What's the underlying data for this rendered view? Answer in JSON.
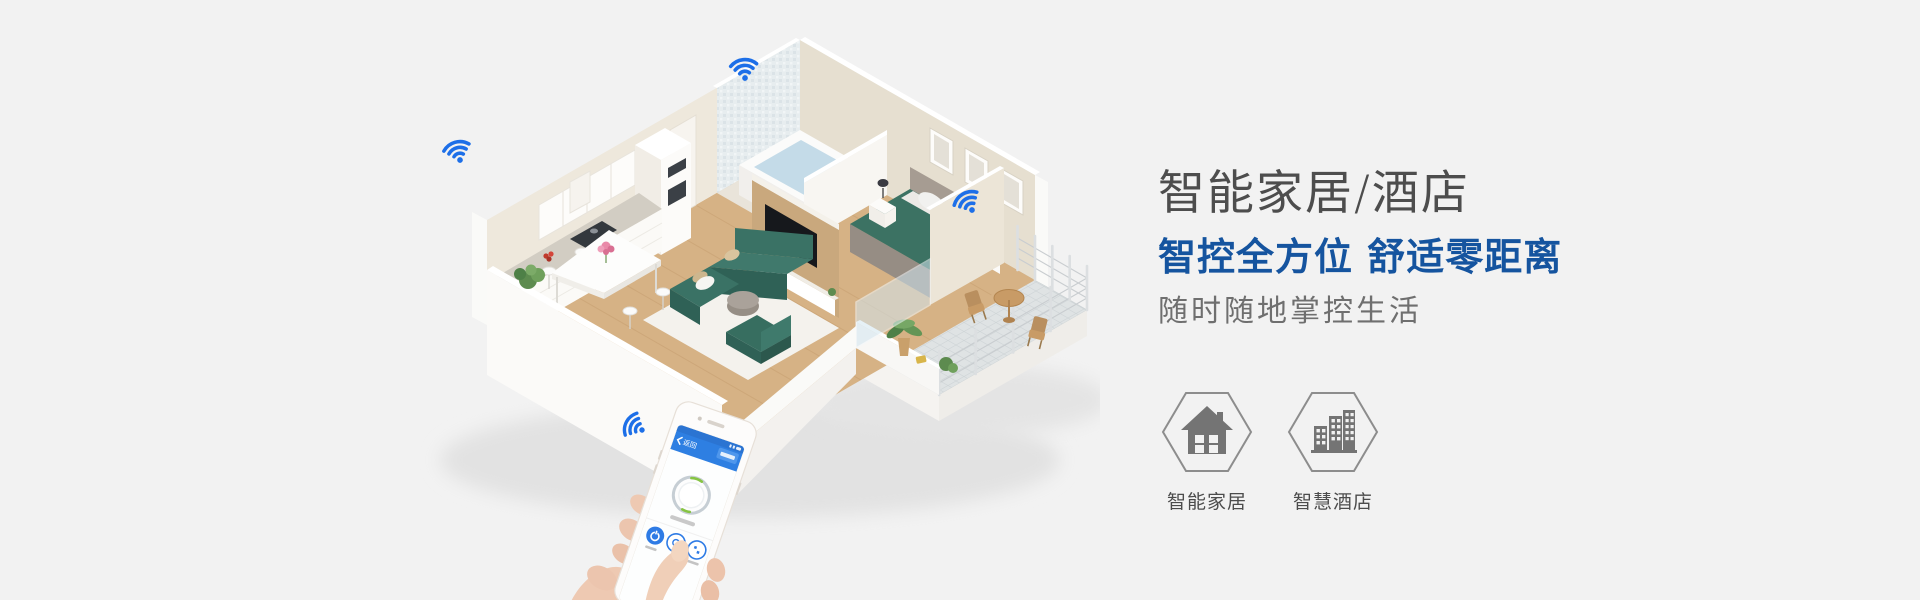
{
  "page": {
    "background_color": "#f2f2f2"
  },
  "hero": {
    "title": "智能家居/酒店",
    "headline": "智控全方位 舒适零距离",
    "subtitle": "随时随地掌控生活",
    "colors": {
      "title": "#4d4d4d",
      "headline": "#15549f",
      "subtitle": "#6f6f6f"
    }
  },
  "features": [
    {
      "id": "smart-home",
      "label": "智能家居",
      "icon": "house-icon"
    },
    {
      "id": "smart-hotel",
      "label": "智慧酒店",
      "icon": "buildings-icon"
    }
  ],
  "illustration": {
    "description": "isometric cutaway apartment with wifi hotspots and hand holding smartphone",
    "rooms": [
      "kitchen",
      "bathroom",
      "bedroom",
      "living-room",
      "dining-area",
      "balcony"
    ],
    "wifi_icon_count": 4,
    "wifi_color": "#1d6fe8",
    "palette": {
      "wood_floor": "#d6b285",
      "walls": "#e9e2d4",
      "sofa": "#3a7265",
      "bed_blanket": "#3c7263",
      "rug": "#f4f2ed",
      "balcony_tile": "#dfe3e4"
    }
  },
  "phone": {
    "back_label": "返回",
    "header_color": "#2e7fe2",
    "accent_color": "#2e7be5",
    "screen_elements": [
      "back-chevron-icon",
      "dial-knob",
      "power-button-icon"
    ],
    "round_buttons": 3
  }
}
